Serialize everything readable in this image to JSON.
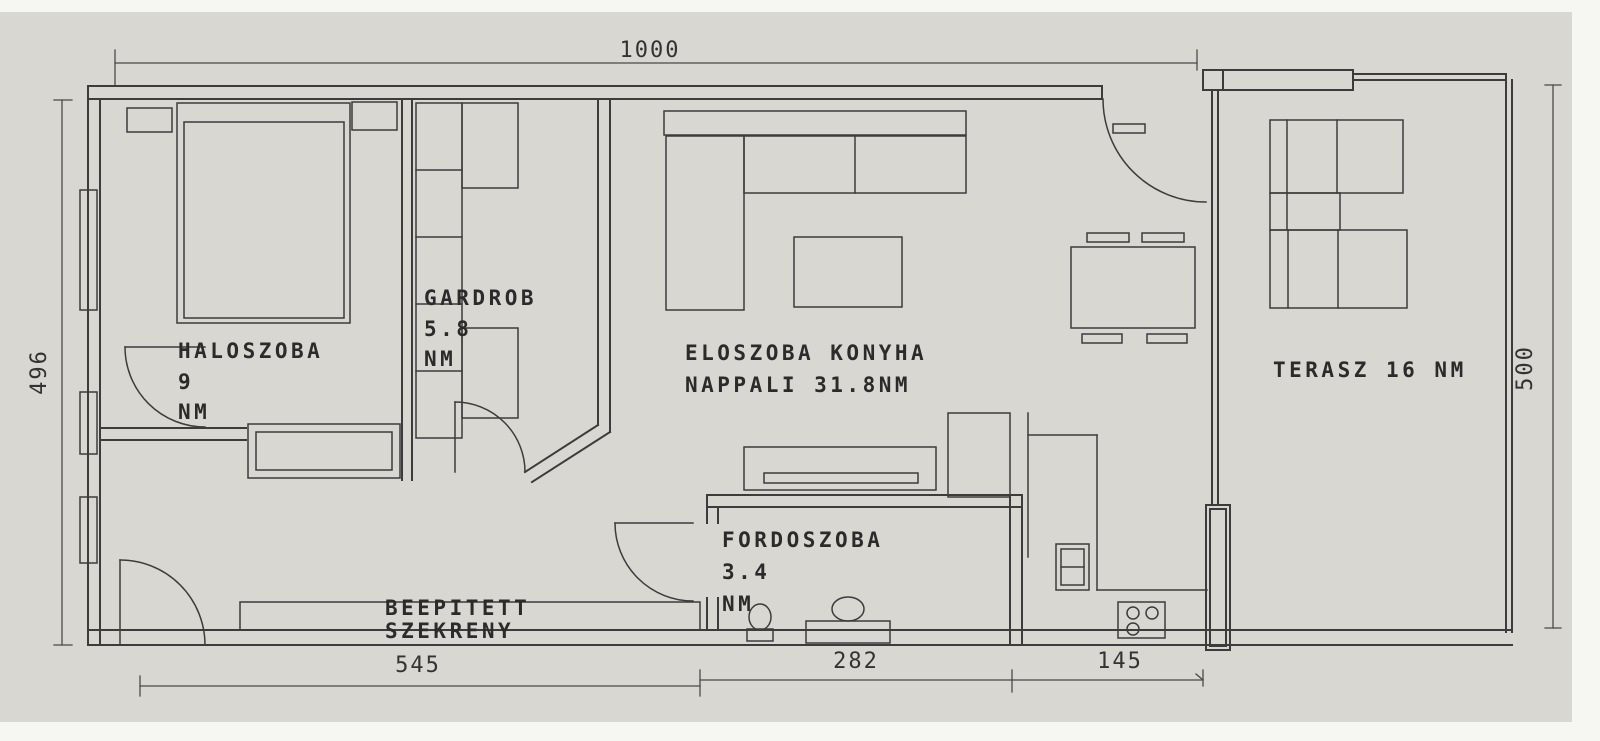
{
  "drawing": {
    "type": "apartment-floor-plan",
    "background_color": "#d8d7d2",
    "line_color": "#3c3c3c",
    "text_color": "#2b2b2b"
  },
  "labels": {
    "bedroom": {
      "l1": "HALOSZOBA",
      "l2": "9",
      "l3": "NM"
    },
    "wardrobe": {
      "l1": "GARDROB",
      "l2": "5.8",
      "l3": "NM"
    },
    "living": {
      "l1": "ELOSZOBA KONYHA",
      "l2": "NAPPALI 31.8NM"
    },
    "bathroom": {
      "l1": "FORDOSZOBA",
      "l2": "3.4",
      "l3": "NM"
    },
    "terrace": {
      "l1": "TERASZ 16 NM"
    },
    "closet": {
      "l1": "BEEPITETT",
      "l2": "SZEKRENY"
    }
  },
  "dimensions": {
    "top": "1000",
    "left": "496",
    "right": "500",
    "bottom_left": "545",
    "bottom_center": "282",
    "bottom_right": "145"
  }
}
